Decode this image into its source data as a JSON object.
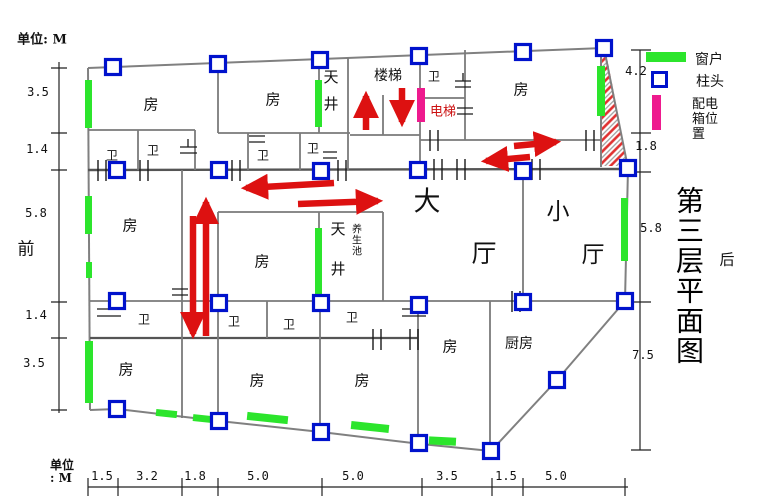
{
  "unit_top": "单位: M",
  "unit_bottom": [
    "单位",
    ": M"
  ],
  "orientation": {
    "front": "前",
    "back": "后"
  },
  "title_vertical": "第三层平面图",
  "legend": {
    "window": "窗户",
    "column": "柱头",
    "power_box": "配电箱位置"
  },
  "rooms": [
    "房",
    "房",
    "房",
    "房",
    "房",
    "房",
    "房",
    "房",
    "房"
  ],
  "kitchen": "厨房",
  "toilets": [
    "卫",
    "卫",
    "卫",
    "卫",
    "卫",
    "卫",
    "卫",
    "卫",
    "卫"
  ],
  "stairs": "楼梯",
  "elevator": "电梯",
  "lightwell_top": "天井",
  "lightwell_mid": "天井",
  "health_pool": "养生池",
  "halls": {
    "big_1": "大",
    "big_2": "厅",
    "small_1": "小",
    "small_2": "厅"
  },
  "dims_left": [
    "3.5",
    "1.4",
    "5.8",
    "1.4",
    "3.5"
  ],
  "dims_right": [
    "4.2",
    "1.8",
    "5.8",
    "7.5"
  ],
  "dims_bottom": [
    "1.5",
    "3.2",
    "1.8",
    "5.0",
    "5.0",
    "3.5",
    "1.5",
    "5.0"
  ],
  "colors": {
    "window": "#2ce52c",
    "column": "#0012cc",
    "power_box": "#ee1a8e",
    "arrow": "#dd1111",
    "wall": "#808080"
  }
}
